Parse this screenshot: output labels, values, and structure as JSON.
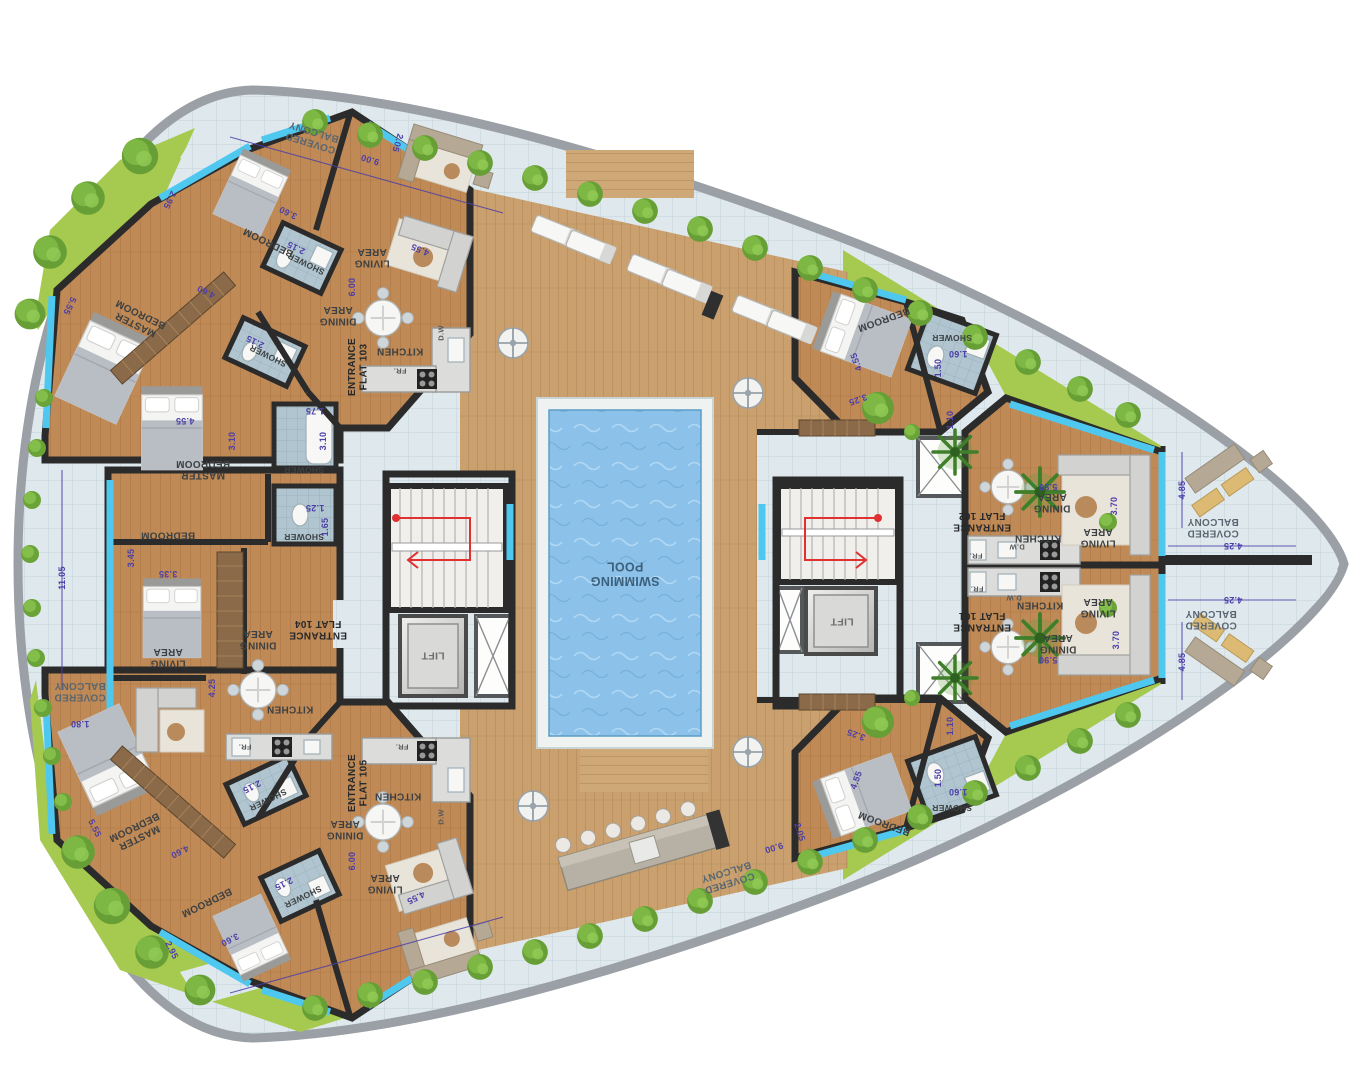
{
  "title": "Residential floor plan — pool deck level with flats 101-105",
  "palette": {
    "lawn": "#a6c94f",
    "deck_wood": "#c9a06e",
    "flat_wood": "#bf8a55",
    "pool_water": "#8cc2ea",
    "walkway_tile": "#dfe9ed",
    "bath_tile": "#b0c5cf",
    "wall": "#2b2b2b",
    "window_glass": "#4fc8f0",
    "dimension_text": "#4c3fa8",
    "room_text": "#3d4042",
    "stair_route_red": "#e03030"
  },
  "icons": [
    "tree-icon",
    "palm-icon",
    "bush-icon",
    "umbrella-table-icon",
    "sun-lounger-icon",
    "dining-table-icon",
    "stove-icon",
    "bed-icon",
    "stairs-icon",
    "lift-icon",
    "pool-icon"
  ],
  "flats": [
    "FLAT 101",
    "FLAT 102",
    "FLAT 103",
    "FLAT 104",
    "FLAT 105"
  ],
  "labels": [
    {
      "t": [
        "COVERED",
        "BALCONY"
      ],
      "x": 312,
      "y": 138,
      "r": 197,
      "c": "balcony"
    },
    {
      "t": "9.00",
      "x": 370,
      "y": 160,
      "r": 197,
      "c": "dim"
    },
    {
      "t": "2.05",
      "x": 398,
      "y": 143,
      "r": 107,
      "c": "dim"
    },
    {
      "t": "BEDROOM",
      "x": 268,
      "y": 243,
      "r": 206,
      "c": "room"
    },
    {
      "t": "3.60",
      "x": 288,
      "y": 213,
      "r": 206,
      "c": "dim"
    },
    {
      "t": "2.95",
      "x": 170,
      "y": 200,
      "r": 116,
      "c": "dim"
    },
    {
      "t": "SHOWER",
      "x": 306,
      "y": 264,
      "r": 206,
      "c": "room",
      "s": 8.5
    },
    {
      "t": "2.15",
      "x": 296,
      "y": 248,
      "r": 206,
      "c": "dim"
    },
    {
      "t": [
        "MASTER",
        "BEDROOM"
      ],
      "x": 138,
      "y": 320,
      "r": 206,
      "c": "room"
    },
    {
      "t": "4.60",
      "x": 206,
      "y": 292,
      "r": 206,
      "c": "dim"
    },
    {
      "t": "5.55",
      "x": 70,
      "y": 306,
      "r": 116,
      "c": "dim"
    },
    {
      "t": "SHOWER",
      "x": 268,
      "y": 356,
      "r": 206,
      "c": "room",
      "s": 8.5
    },
    {
      "t": "2.15",
      "x": 255,
      "y": 342,
      "r": 206,
      "c": "dim"
    },
    {
      "t": [
        "LIVING",
        "AREA"
      ],
      "x": 372,
      "y": 258,
      "r": 180,
      "c": "room"
    },
    {
      "t": "4.55",
      "x": 420,
      "y": 250,
      "r": 203,
      "c": "dim"
    },
    {
      "t": [
        "DINING",
        "AREA"
      ],
      "x": 338,
      "y": 316,
      "r": 180,
      "c": "room"
    },
    {
      "t": "6.00",
      "x": 352,
      "y": 287,
      "r": 270,
      "c": "dim"
    },
    {
      "t": "KITCHEN",
      "x": 400,
      "y": 352,
      "r": 180,
      "c": "room"
    },
    {
      "t": [
        "ENTRANCE",
        "FLAT 103"
      ],
      "x": 357,
      "y": 367,
      "r": 270,
      "c": "entrance"
    },
    {
      "t": "FR.",
      "x": 400,
      "y": 371,
      "r": 180,
      "c": "tiny"
    },
    {
      "t": "D.W",
      "x": 441,
      "y": 333,
      "r": 270,
      "c": "tiny"
    },
    {
      "t": [
        "MASTER",
        "BEDROOM"
      ],
      "x": 203,
      "y": 470,
      "r": 180,
      "c": "room"
    },
    {
      "t": "4.55",
      "x": 185,
      "y": 421,
      "r": 180,
      "c": "dim"
    },
    {
      "t": "3.10",
      "x": 232,
      "y": 441,
      "r": 270,
      "c": "dim"
    },
    {
      "t": "SHOWER",
      "x": 304,
      "y": 470,
      "r": 180,
      "c": "room",
      "s": 8.5
    },
    {
      "t": "1.75",
      "x": 315,
      "y": 411,
      "r": 180,
      "c": "dim"
    },
    {
      "t": "3.10",
      "x": 323,
      "y": 441,
      "r": 270,
      "c": "dim"
    },
    {
      "t": "SHOWER",
      "x": 304,
      "y": 537,
      "r": 180,
      "c": "room",
      "s": 8.5
    },
    {
      "t": "1.25",
      "x": 315,
      "y": 508,
      "r": 180,
      "c": "dim"
    },
    {
      "t": "1.65",
      "x": 325,
      "y": 527,
      "r": 270,
      "c": "dim"
    },
    {
      "t": "BEDROOM",
      "x": 168,
      "y": 536,
      "r": 180,
      "c": "room"
    },
    {
      "t": "3.35",
      "x": 168,
      "y": 574,
      "r": 180,
      "c": "dim"
    },
    {
      "t": "3.45",
      "x": 131,
      "y": 558,
      "r": 270,
      "c": "dim"
    },
    {
      "t": [
        "DINING",
        "AREA"
      ],
      "x": 258,
      "y": 640,
      "r": 180,
      "c": "room"
    },
    {
      "t": [
        "LIVING",
        "AREA"
      ],
      "x": 168,
      "y": 658,
      "r": 180,
      "c": "room"
    },
    {
      "t": "4.25",
      "x": 212,
      "y": 688,
      "r": 270,
      "c": "dim"
    },
    {
      "t": "KITCHEN",
      "x": 290,
      "y": 710,
      "r": 180,
      "c": "room"
    },
    {
      "t": "FR.",
      "x": 245,
      "y": 747,
      "r": 180,
      "c": "tiny"
    },
    {
      "t": [
        "ENTRANCE",
        "FLAT 104"
      ],
      "x": 318,
      "y": 630,
      "r": 180,
      "c": "entrance"
    },
    {
      "t": "LIFT",
      "x": 433,
      "y": 656,
      "r": 180,
      "c": "lift"
    },
    {
      "t": [
        "COVERED",
        "BALCONY"
      ],
      "x": 80,
      "y": 692,
      "r": 180,
      "c": "balcony"
    },
    {
      "t": "11.05",
      "x": 62,
      "y": 578,
      "r": 270,
      "c": "dim"
    },
    {
      "t": "1.80",
      "x": 80,
      "y": 724,
      "r": 180,
      "c": "dim"
    },
    {
      "t": [
        "SWIMMING",
        "POOL"
      ],
      "x": 625,
      "y": 574,
      "r": 180,
      "c": "pool"
    },
    {
      "t": [
        "MASTER",
        "BEDROOM"
      ],
      "x": 137,
      "y": 833,
      "r": 154,
      "c": "room"
    },
    {
      "t": "5.55",
      "x": 95,
      "y": 828,
      "r": 64,
      "c": "dim"
    },
    {
      "t": "4.60",
      "x": 180,
      "y": 852,
      "r": 154,
      "c": "dim"
    },
    {
      "t": "BEDROOM",
      "x": 207,
      "y": 903,
      "r": 154,
      "c": "room"
    },
    {
      "t": "3.60",
      "x": 230,
      "y": 940,
      "r": 154,
      "c": "dim"
    },
    {
      "t": "2.95",
      "x": 172,
      "y": 950,
      "r": 64,
      "c": "dim"
    },
    {
      "t": "SHOWER",
      "x": 268,
      "y": 800,
      "r": 154,
      "c": "room",
      "s": 8.5
    },
    {
      "t": "2.15",
      "x": 252,
      "y": 787,
      "r": 154,
      "c": "dim"
    },
    {
      "t": "SHOWER",
      "x": 303,
      "y": 897,
      "r": 154,
      "c": "room",
      "s": 8.5
    },
    {
      "t": "2.15",
      "x": 284,
      "y": 884,
      "r": 154,
      "c": "dim"
    },
    {
      "t": [
        "LIVING",
        "AREA"
      ],
      "x": 385,
      "y": 884,
      "r": 180,
      "c": "room"
    },
    {
      "t": "4.55",
      "x": 416,
      "y": 898,
      "r": 154,
      "c": "dim"
    },
    {
      "t": [
        "DINING",
        "AREA"
      ],
      "x": 345,
      "y": 830,
      "r": 180,
      "c": "room"
    },
    {
      "t": "6.00",
      "x": 352,
      "y": 861,
      "r": 270,
      "c": "dim"
    },
    {
      "t": "KITCHEN",
      "x": 398,
      "y": 797,
      "r": 180,
      "c": "room"
    },
    {
      "t": [
        "ENTRANCE",
        "FLAT 105"
      ],
      "x": 357,
      "y": 783,
      "r": 270,
      "c": "entrance"
    },
    {
      "t": "FR.",
      "x": 402,
      "y": 747,
      "r": 180,
      "c": "tiny"
    },
    {
      "t": "D.W",
      "x": 441,
      "y": 817,
      "r": 270,
      "c": "tiny"
    },
    {
      "t": [
        "COVERED",
        "BALCONY"
      ],
      "x": 728,
      "y": 878,
      "r": 163,
      "c": "balcony"
    },
    {
      "t": "9.00",
      "x": 774,
      "y": 848,
      "r": 163,
      "c": "dim"
    },
    {
      "t": "2.05",
      "x": 800,
      "y": 832,
      "r": 73,
      "c": "dim"
    },
    {
      "t": "BEDROOM",
      "x": 884,
      "y": 320,
      "r": 160,
      "c": "room"
    },
    {
      "t": "4.55",
      "x": 856,
      "y": 362,
      "r": 250,
      "c": "dim"
    },
    {
      "t": "3.25",
      "x": 858,
      "y": 400,
      "r": 160,
      "c": "dim"
    },
    {
      "t": "SHOWER",
      "x": 952,
      "y": 338,
      "r": 180,
      "c": "room",
      "s": 8.5
    },
    {
      "t": "1.60",
      "x": 958,
      "y": 354,
      "r": 180,
      "c": "dim"
    },
    {
      "t": "1.50",
      "x": 938,
      "y": 368,
      "r": 270,
      "c": "dim"
    },
    {
      "t": "1.10",
      "x": 950,
      "y": 420,
      "r": 270,
      "c": "dim"
    },
    {
      "t": [
        "ENTRANCE",
        "FLAT 102"
      ],
      "x": 982,
      "y": 522,
      "r": 180,
      "c": "entrance"
    },
    {
      "t": [
        "DINING",
        "AREA"
      ],
      "x": 1052,
      "y": 503,
      "r": 180,
      "c": "room"
    },
    {
      "t": "5.90",
      "x": 1048,
      "y": 487,
      "r": 180,
      "c": "dim"
    },
    {
      "t": "KITCHEN",
      "x": 1038,
      "y": 539,
      "r": 180,
      "c": "room"
    },
    {
      "t": "FR.",
      "x": 976,
      "y": 556,
      "r": 180,
      "c": "tiny"
    },
    {
      "t": "D.W",
      "x": 1017,
      "y": 547,
      "r": 180,
      "c": "tiny"
    },
    {
      "t": [
        "LIVING",
        "AREA"
      ],
      "x": 1098,
      "y": 538,
      "r": 180,
      "c": "room"
    },
    {
      "t": "3.70",
      "x": 1114,
      "y": 506,
      "r": 270,
      "c": "dim"
    },
    {
      "t": [
        "COVERED",
        "BALCONY"
      ],
      "x": 1213,
      "y": 528,
      "r": 180,
      "c": "balcony"
    },
    {
      "t": "4.25",
      "x": 1233,
      "y": 546,
      "r": 180,
      "c": "dim"
    },
    {
      "t": "4.85",
      "x": 1182,
      "y": 490,
      "r": 270,
      "c": "dim"
    },
    {
      "t": [
        "ENTRANCE",
        "FLAT 101"
      ],
      "x": 982,
      "y": 622,
      "r": 180,
      "c": "entrance"
    },
    {
      "t": "KITCHEN",
      "x": 1040,
      "y": 606,
      "r": 180,
      "c": "room"
    },
    {
      "t": "FR.",
      "x": 977,
      "y": 589,
      "r": 180,
      "c": "tiny"
    },
    {
      "t": "D.W",
      "x": 1014,
      "y": 598,
      "r": 180,
      "c": "tiny"
    },
    {
      "t": [
        "DINING",
        "AREA"
      ],
      "x": 1058,
      "y": 644,
      "r": 180,
      "c": "room"
    },
    {
      "t": "5.90",
      "x": 1048,
      "y": 660,
      "r": 180,
      "c": "dim"
    },
    {
      "t": [
        "LIVING",
        "AREA"
      ],
      "x": 1098,
      "y": 608,
      "r": 180,
      "c": "room"
    },
    {
      "t": "3.70",
      "x": 1116,
      "y": 640,
      "r": 270,
      "c": "dim"
    },
    {
      "t": [
        "COVERED",
        "BALCONY"
      ],
      "x": 1211,
      "y": 620,
      "r": 180,
      "c": "balcony"
    },
    {
      "t": "4.25",
      "x": 1233,
      "y": 600,
      "r": 180,
      "c": "dim"
    },
    {
      "t": "4.85",
      "x": 1182,
      "y": 662,
      "r": 270,
      "c": "dim"
    },
    {
      "t": "BEDROOM",
      "x": 884,
      "y": 824,
      "r": 200,
      "c": "room"
    },
    {
      "t": "4.55",
      "x": 856,
      "y": 780,
      "r": 290,
      "c": "dim"
    },
    {
      "t": "3.25",
      "x": 856,
      "y": 735,
      "r": 200,
      "c": "dim"
    },
    {
      "t": "SHOWER",
      "x": 952,
      "y": 808,
      "r": 180,
      "c": "room",
      "s": 8.5
    },
    {
      "t": "1.60",
      "x": 958,
      "y": 792,
      "r": 180,
      "c": "dim"
    },
    {
      "t": "1.50",
      "x": 938,
      "y": 778,
      "r": 270,
      "c": "dim"
    },
    {
      "t": "1.10",
      "x": 950,
      "y": 726,
      "r": 270,
      "c": "dim"
    },
    {
      "t": "LIFT",
      "x": 842,
      "y": 622,
      "r": 180,
      "c": "lift"
    }
  ]
}
